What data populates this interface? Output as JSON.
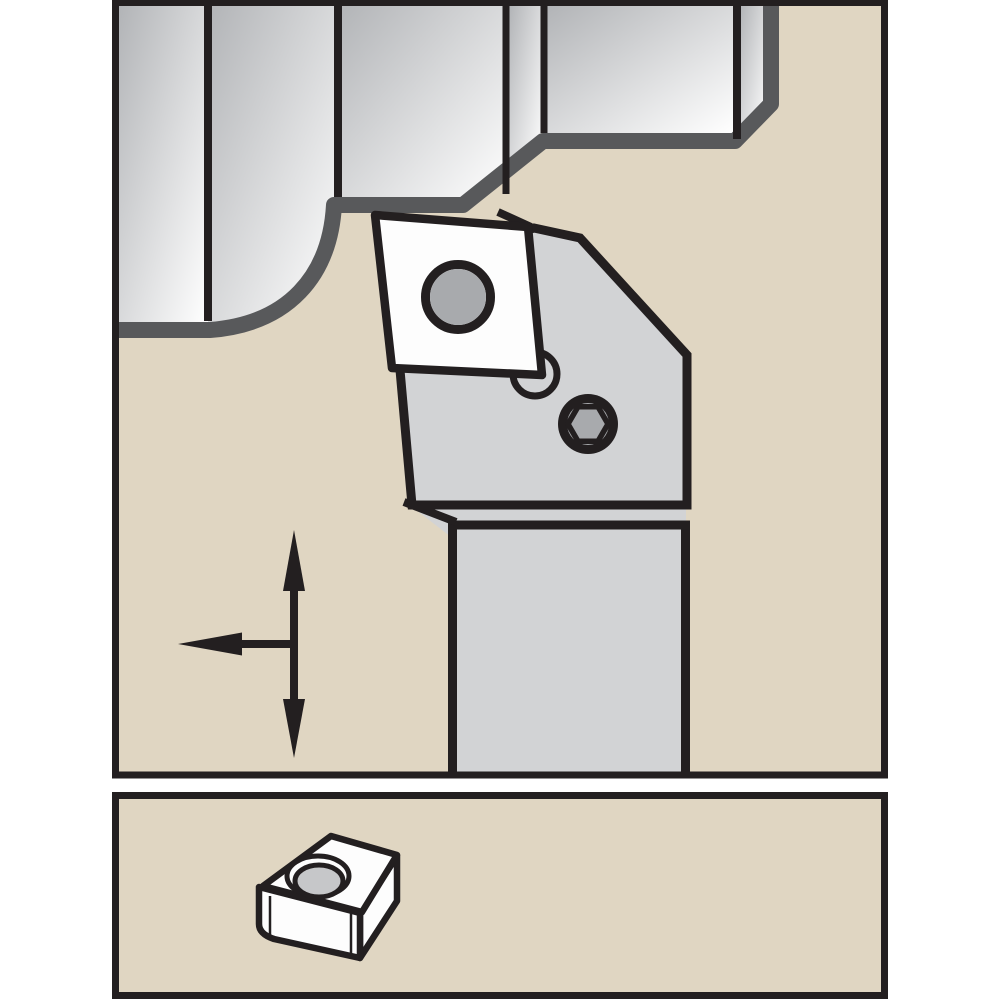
{
  "illustration": {
    "kind": "machining-toolholder-technical-drawing",
    "upper_panel": {
      "name": "turning-operation-view",
      "components": [
        "stepped-workpiece",
        "machined-profile-surface",
        "tool-head",
        "tool-shank",
        "indexable-insert",
        "insert-center-hole",
        "clamp-hole",
        "hex-socket-clamp-screw",
        "feed-direction-arrows"
      ]
    },
    "lower_panel": {
      "name": "insert-detail-view",
      "components": [
        "indexable-insert-3d",
        "insert-countersunk-hole"
      ]
    },
    "colors": {
      "page-white": "#ffffff",
      "panel-fill": "#e0d6c2",
      "outline-black": "#231f20",
      "machined-gray": "#58595b",
      "holder-gray": "#d2d3d5",
      "insert-white": "#fdfdfd",
      "hole-gray": "#a8aaad",
      "bore-gray": "#c6c7c9",
      "workpiece-grad-start": "#b2b4b7",
      "workpiece-grad-end": "#ffffff"
    }
  }
}
